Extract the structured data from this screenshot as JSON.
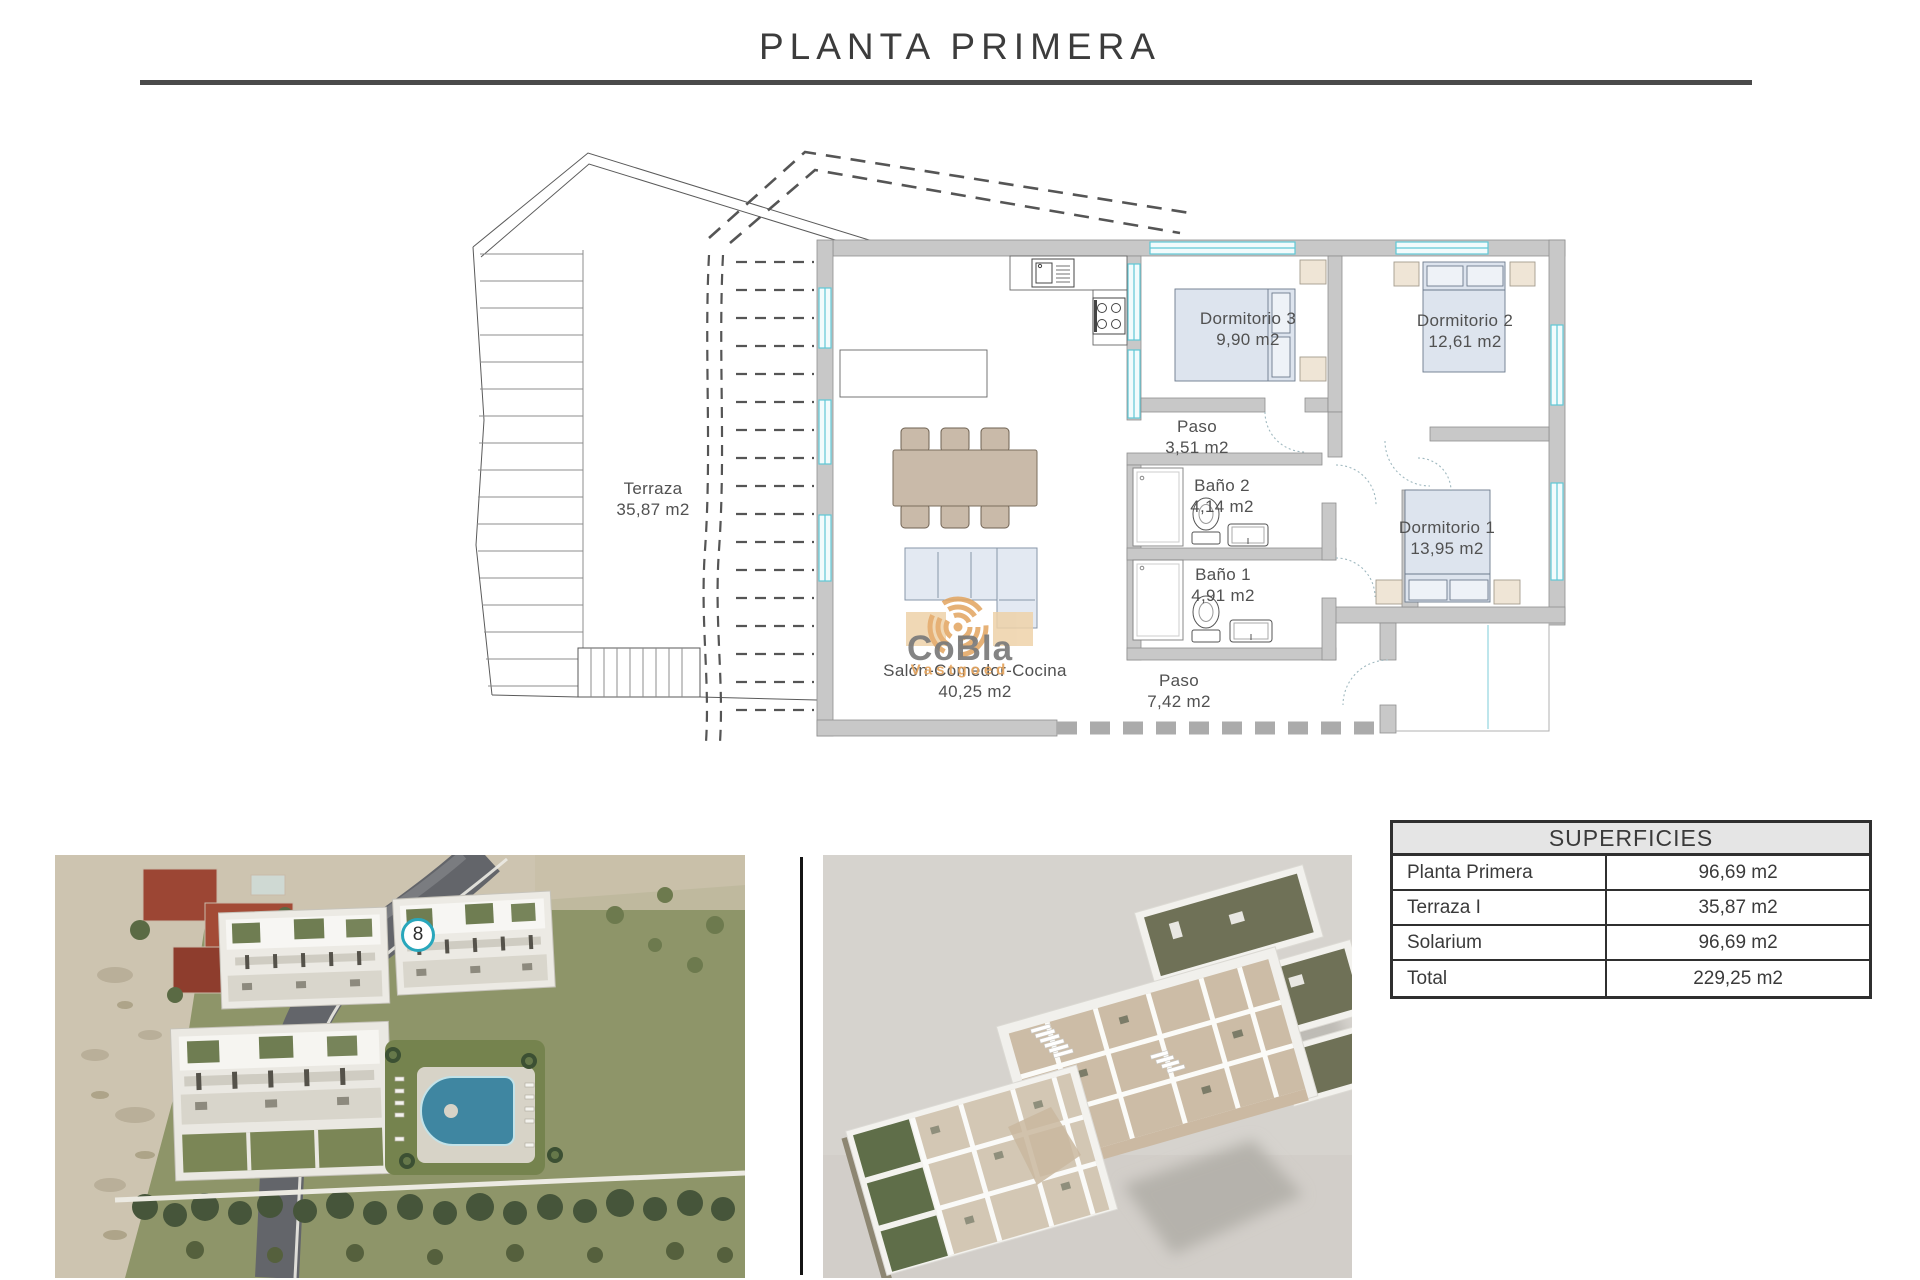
{
  "title": "PLANTA PRIMERA",
  "plan": {
    "terraza": {
      "name": "Terraza",
      "area": "35,87 m2"
    },
    "dorm3": {
      "name": "Dormitorio 3",
      "area": "9,90 m2"
    },
    "dorm2": {
      "name": "Dormitorio 2",
      "area": "12,61 m2"
    },
    "paso1": {
      "name": "Paso",
      "area": "3,51 m2"
    },
    "bano2": {
      "name": "Baño 2",
      "area": "4,14 m2"
    },
    "bano1": {
      "name": "Baño 1",
      "area": "4,91 m2"
    },
    "dorm1": {
      "name": "Dormitorio 1",
      "area": "13,95 m2"
    },
    "salon": {
      "name": "Salón-Comedor-Cocina",
      "area": "40,25 m2"
    },
    "paso2": {
      "name": "Paso",
      "area": "7,42 m2"
    }
  },
  "watermark": {
    "brand": "CoBla",
    "sub": "Vastgoed"
  },
  "aerial": {
    "unit_badge": "8"
  },
  "superficies": {
    "header": "SUPERFICIES",
    "rows": [
      {
        "label": "Planta Primera",
        "value": "96,69 m2"
      },
      {
        "label": "Terraza I",
        "value": "35,87 m2"
      },
      {
        "label": "Solarium",
        "value": "96,69 m2"
      },
      {
        "label": "Total",
        "value": "229,25 m2"
      }
    ]
  },
  "colors": {
    "window_cyan": "#5fc8d6",
    "logo_orange": "#e2a45f",
    "badge_teal": "#29a7bc",
    "wall_gray": "#c8c8c8"
  }
}
